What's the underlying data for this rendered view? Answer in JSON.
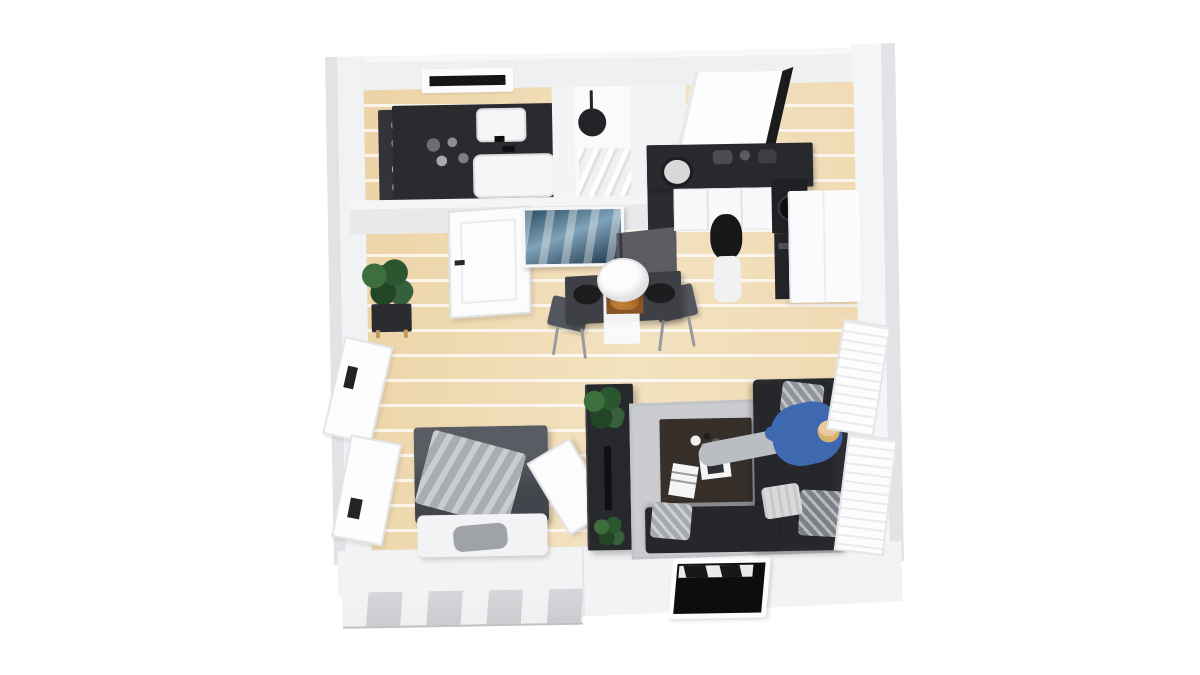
{
  "meta": {
    "title": "3D floor plan rendering of a studio apartment",
    "view": "top-down isometric render",
    "background": "#ffffff"
  },
  "colors": {
    "wood": "#ecd3a6",
    "wallOuter": "#e2e3e6",
    "dark": "#2a2b2f",
    "duvet": "#4b4f56",
    "throw": "#a9adb2",
    "rug": "#cacccf",
    "sofa": "#25272b",
    "tableWood": "#362f2a",
    "art1": "#2b4d66",
    "art2": "#7fa3b8",
    "accentBlue": "#3e68b0",
    "marble": "#d6d7da",
    "plantGreen": "#2f5b33"
  },
  "rooms": [
    {
      "name": "bathroom",
      "position": "top-left",
      "items": [
        "dark double-sink vanity",
        "two white basins",
        "towel shelf with rolled towels",
        "walk-in shower",
        "round rain shower head",
        "small wall window"
      ]
    },
    {
      "name": "kitchen",
      "position": "top-right",
      "items": [
        "L-shaped dark countertop",
        "round sink",
        "cooktop",
        "oven column",
        "tall white fridge cabinet",
        "white base cabinets",
        "large window",
        "standing person in black top and white pants",
        "dark stool"
      ]
    },
    {
      "name": "dining-area",
      "position": "center",
      "items": [
        "dark dining table",
        "white table runner",
        "food board",
        "two plates",
        "two gray chairs",
        "white pendant lamp"
      ]
    },
    {
      "name": "entry",
      "position": "center-left",
      "items": [
        "white interior door",
        "blue seascape painting",
        "potted green plant on stand"
      ]
    },
    {
      "name": "bedroom",
      "position": "bottom-left",
      "items": [
        "double bed with dark gray duvet",
        "light gray throw blanket",
        "white pillows",
        "gray accent pillow",
        "two windows on left wall"
      ]
    },
    {
      "name": "living-room",
      "position": "bottom-right",
      "items": [
        "dark corner sofa",
        "person in blue sweater lying on sofa",
        "gray area rug",
        "dark wood coffee table with magazines",
        "media console with plants",
        "leaning white panel",
        "louvered white wall panels",
        "front facade window"
      ]
    }
  ]
}
